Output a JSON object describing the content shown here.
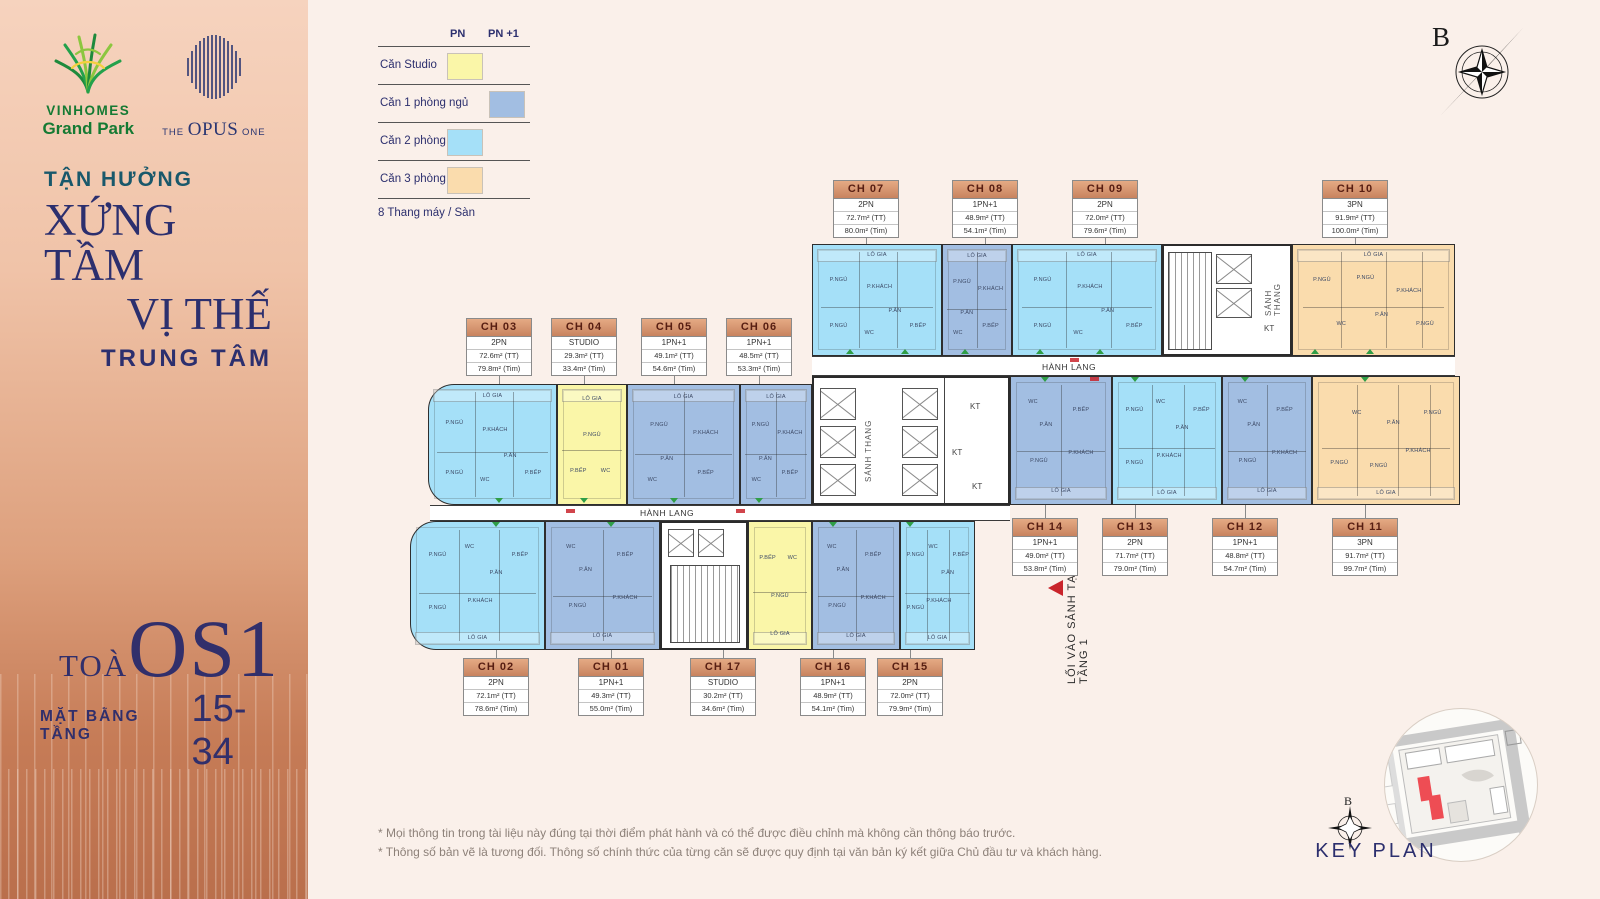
{
  "sidebar": {
    "brand_primary": {
      "name": "VINHOMES",
      "subname": "Grand Park"
    },
    "brand_secondary": {
      "pre": "THE",
      "main": "OPUS",
      "post": "ONE"
    },
    "tagline_small": "TẬN HƯỞNG",
    "tagline_line1": "XỨNG TẦM",
    "tagline_line2": "VỊ THẾ",
    "tagline_line3": "TRUNG TÂM",
    "tower_prefix": "TOÀ",
    "tower_name": "OS1",
    "floor_label": "MẶT BẰNG TẦNG",
    "floor_range": "15-34"
  },
  "legend": {
    "col1": "PN",
    "col2": "PN +1",
    "items": [
      {
        "label": "Căn Studio",
        "column": "pn",
        "color": "#FAF6A8",
        "key": "studio"
      },
      {
        "label": "Căn 1 phòng ngủ",
        "column": "pn1",
        "color": "#A2BEE2",
        "key": "1pn"
      },
      {
        "label": "Căn 2 phòng ngủ",
        "column": "pn",
        "color": "#A5E0F8",
        "key": "2pn"
      },
      {
        "label": "Căn 3 phòng ngủ",
        "column": "pn",
        "color": "#FADCAD",
        "key": "3pn"
      }
    ],
    "footnote": "8 Thang máy / Sàn"
  },
  "compass": {
    "label": "B"
  },
  "plan": {
    "corridor_label": "HÀNH LANG",
    "stair_lobby_label": "SẢNH THANG",
    "technical_label": "KT",
    "entrance_label": "LỐI VÀO SẢNH TẠI TẦNG 1",
    "room_labels": [
      "P.NGỦ",
      "P.KHÁCH",
      "P.ĂN",
      "P.BẾP",
      "WC",
      "LÔ GIA"
    ],
    "units": [
      {
        "code": "CH 01",
        "type": "1PN+1",
        "area_tt": "49.3m² (TT)",
        "area_tim": "55.0m² (Tim)",
        "category": "1pn"
      },
      {
        "code": "CH 02",
        "type": "2PN",
        "area_tt": "72.1m² (TT)",
        "area_tim": "78.6m² (Tim)",
        "category": "2pn"
      },
      {
        "code": "CH 03",
        "type": "2PN",
        "area_tt": "72.6m² (TT)",
        "area_tim": "79.8m² (Tim)",
        "category": "2pn"
      },
      {
        "code": "CH 04",
        "type": "STUDIO",
        "area_tt": "29.3m² (TT)",
        "area_tim": "33.4m² (Tim)",
        "category": "studio"
      },
      {
        "code": "CH 05",
        "type": "1PN+1",
        "area_tt": "49.1m² (TT)",
        "area_tim": "54.6m² (Tim)",
        "category": "1pn"
      },
      {
        "code": "CH 06",
        "type": "1PN+1",
        "area_tt": "48.5m² (TT)",
        "area_tim": "53.3m² (Tim)",
        "category": "1pn"
      },
      {
        "code": "CH 07",
        "type": "2PN",
        "area_tt": "72.7m² (TT)",
        "area_tim": "80.0m² (Tim)",
        "category": "2pn"
      },
      {
        "code": "CH 08",
        "type": "1PN+1",
        "area_tt": "48.9m² (TT)",
        "area_tim": "54.1m² (Tim)",
        "category": "1pn"
      },
      {
        "code": "CH 09",
        "type": "2PN",
        "area_tt": "72.0m² (TT)",
        "area_tim": "79.6m² (Tim)",
        "category": "2pn"
      },
      {
        "code": "CH 10",
        "type": "3PN",
        "area_tt": "91.9m² (TT)",
        "area_tim": "100.0m² (Tim)",
        "category": "3pn"
      },
      {
        "code": "CH 11",
        "type": "3PN",
        "area_tt": "91.7m² (TT)",
        "area_tim": "99.7m² (Tim)",
        "category": "3pn"
      },
      {
        "code": "CH 12",
        "type": "1PN+1",
        "area_tt": "48.8m² (TT)",
        "area_tim": "54.7m² (Tim)",
        "category": "1pn"
      },
      {
        "code": "CH 13",
        "type": "2PN",
        "area_tt": "71.7m² (TT)",
        "area_tim": "79.0m² (Tim)",
        "category": "2pn"
      },
      {
        "code": "CH 14",
        "type": "1PN+1",
        "area_tt": "49.0m² (TT)",
        "area_tim": "53.8m² (Tim)",
        "category": "1pn"
      },
      {
        "code": "CH 15",
        "type": "2PN",
        "area_tt": "72.0m² (TT)",
        "area_tim": "79.9m² (Tim)",
        "category": "2pn"
      },
      {
        "code": "CH 16",
        "type": "1PN+1",
        "area_tt": "48.9m² (TT)",
        "area_tim": "54.1m² (Tim)",
        "category": "1pn"
      },
      {
        "code": "CH 17",
        "type": "STUDIO",
        "area_tt": "30.2m² (TT)",
        "area_tim": "34.6m² (Tim)",
        "category": "studio"
      }
    ]
  },
  "keyplan": {
    "title": "KEY PLAN",
    "compass_label": "B",
    "highlight_color": "#EE4D54"
  },
  "footer": {
    "line1": "* Mọi thông tin trong tài liệu này đúng tại thời điểm phát hành và có thể được điều chỉnh mà không cần thông báo trước.",
    "line2": "* Thông số bản vẽ là tương đối. Thông số chính thức của từng căn sẽ được quy định tại văn bản ký kết giữa Chủ đầu tư và khách hàng."
  }
}
